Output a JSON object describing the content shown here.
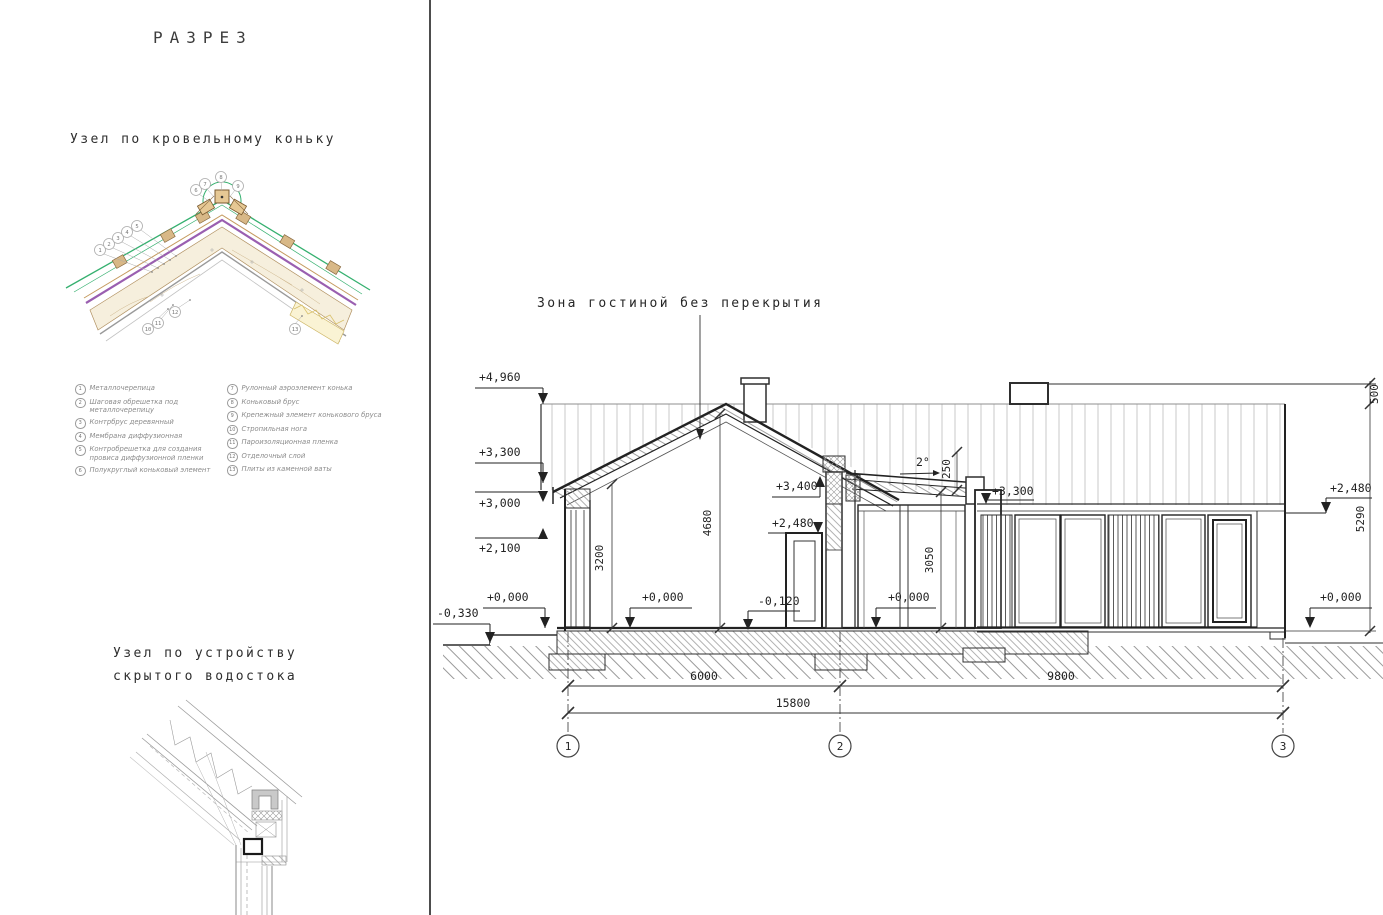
{
  "page": {
    "title": "РАЗРЕЗ"
  },
  "ridge_detail": {
    "heading": "Узел по кровельному коньку",
    "callouts": [
      "1",
      "2",
      "3",
      "4",
      "5",
      "6",
      "7",
      "8",
      "9",
      "10",
      "11",
      "12",
      "13"
    ],
    "legend_left": [
      {
        "num": "1",
        "text": "Металлочерепица"
      },
      {
        "num": "2",
        "text": "Шаговая обрешетка под металлочерепицу"
      },
      {
        "num": "3",
        "text": "Контрбрус деревянный"
      },
      {
        "num": "4",
        "text": "Мембрана диффузионная"
      },
      {
        "num": "5",
        "text": "Контробрешетка для создания провиса диффузионной пленки"
      },
      {
        "num": "6",
        "text": "Полукруглый коньковый элемент"
      }
    ],
    "legend_right": [
      {
        "num": "7",
        "text": "Рулонный аэроэлемент конька"
      },
      {
        "num": "8",
        "text": "Коньковый брус"
      },
      {
        "num": "9",
        "text": "Крепежный элемент конькового бруса"
      },
      {
        "num": "10",
        "text": "Стропильная нога"
      },
      {
        "num": "11",
        "text": "Пароизоляционная пленка"
      },
      {
        "num": "12",
        "text": "Отделочный слой"
      },
      {
        "num": "13",
        "text": "Плиты из каменной ваты"
      }
    ]
  },
  "drain_detail": {
    "heading_line1": "Узел по устройству",
    "heading_line2": "скрытого водостока"
  },
  "section": {
    "zone_label": "Зона гостиной без перекрытия",
    "angle_label": "2°",
    "elevations": {
      "left_4960": "+4,960",
      "left_3300": "+3,300",
      "left_3000": "+3,000",
      "left_2100": "+2,100",
      "left_0000": "+0,000",
      "left_m330": "-0,330",
      "interior_0000": "+0,000",
      "mid_3400": "+3,400",
      "mid_2480": "+2,480",
      "mid_m120": "-0,120",
      "link_0000": "+0,000",
      "right_3300": "+3,300",
      "right_2480": "+2,480",
      "right_0000": "+0,000"
    },
    "dimensions": {
      "wall_height": "3200",
      "ridge_height": "4680",
      "link_height": "3050",
      "roof_thickness": "250",
      "parapet": "500",
      "right_height": "5290",
      "span_1_2": "6000",
      "span_2_3": "9800",
      "span_total": "15800"
    },
    "grid_axes": [
      "1",
      "2",
      "3"
    ],
    "colors": {
      "line": "#2f2f2f",
      "light_line": "#c9c9c9",
      "detail_green": "#35b06f",
      "detail_purple": "#9a5fb0",
      "detail_brown": "#8a6a40",
      "detail_tan": "#d8b887",
      "detail_yellow": "#e3cf7a"
    }
  }
}
